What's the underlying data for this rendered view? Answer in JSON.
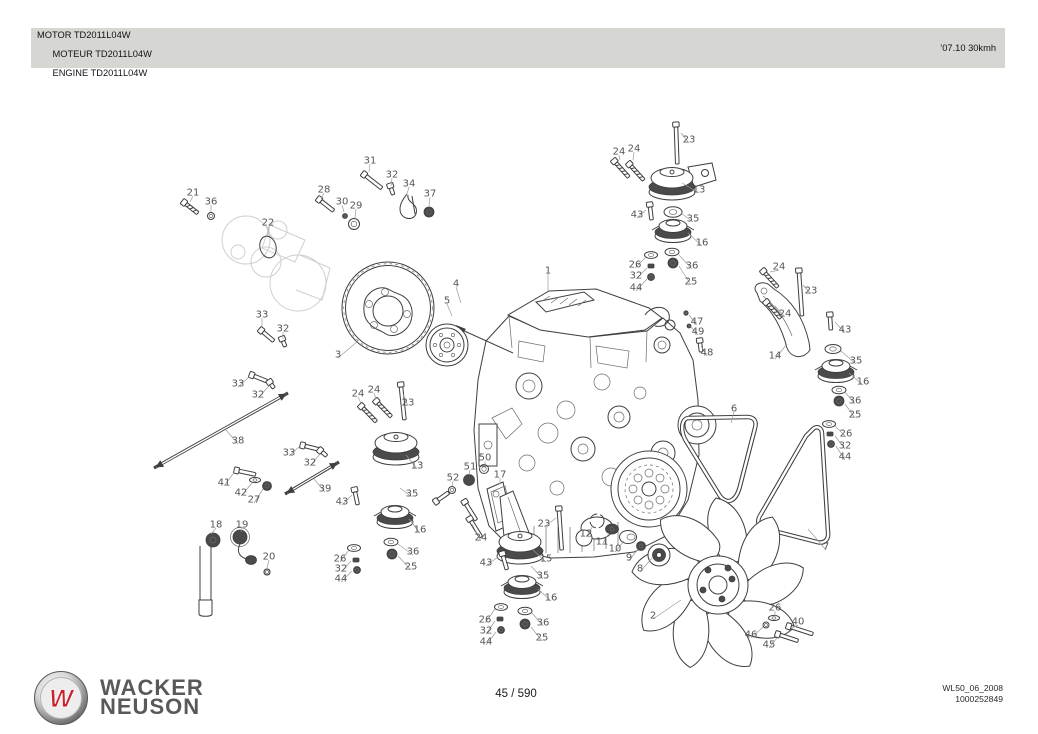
{
  "header": {
    "title_lines": [
      "MOTOR TD2011L04W",
      "MOTEUR TD2011L04W",
      "ENGINE TD2011L04W"
    ],
    "edition": "’07.10 30kmh"
  },
  "footer": {
    "logo_letter": "W",
    "brand_line1": "WACKER",
    "brand_line2": "NEUSON",
    "page_indicator": "45 / 590",
    "doc_code": "WL50_06_2008",
    "doc_number": "1000252849"
  },
  "colors": {
    "header_bar": "#d6d7d3",
    "line_art": "#3f3f3f",
    "callout_text": "#565656",
    "brand_gray": "#59595b",
    "logo_red": "#c8232e"
  },
  "diagram": {
    "description": "Exploded parts view of Deutz engine TD2011L04W with numbered callouts",
    "callouts": [
      {
        "n": "1",
        "x": 548,
        "y": 270,
        "l": [
          548,
          291
        ]
      },
      {
        "n": "2",
        "x": 653,
        "y": 615,
        "l": [
          681,
          600
        ]
      },
      {
        "n": "3",
        "x": 338,
        "y": 354,
        "l": [
          358,
          341
        ]
      },
      {
        "n": "4",
        "x": 456,
        "y": 283,
        "l": [
          461,
          303
        ]
      },
      {
        "n": "5",
        "x": 447,
        "y": 300,
        "l": [
          452,
          316
        ]
      },
      {
        "n": "6",
        "x": 734,
        "y": 408,
        "l": [
          731,
          423
        ]
      },
      {
        "n": "7",
        "x": 826,
        "y": 546,
        "l": [
          808,
          529
        ]
      },
      {
        "n": "8",
        "x": 640,
        "y": 568,
        "l": [
          652,
          558
        ]
      },
      {
        "n": "9",
        "x": 629,
        "y": 557,
        "l": [
          638,
          549
        ]
      },
      {
        "n": "10",
        "x": 615,
        "y": 548,
        "l": [
          624,
          541
        ]
      },
      {
        "n": "11",
        "x": 602,
        "y": 541,
        "l": [
          609,
          533
        ]
      },
      {
        "n": "12",
        "x": 586,
        "y": 533,
        "l": [
          593,
          526
        ]
      },
      {
        "n": "13",
        "x": 699,
        "y": 189,
        "l": [
          682,
          183
        ]
      },
      {
        "n": "13",
        "x": 417,
        "y": 465,
        "l": [
          406,
          455
        ]
      },
      {
        "n": "14",
        "x": 775,
        "y": 355,
        "l": [
          787,
          344
        ]
      },
      {
        "n": "15",
        "x": 546,
        "y": 558,
        "l": [
          532,
          549
        ]
      },
      {
        "n": "16",
        "x": 702,
        "y": 242,
        "l": [
          688,
          233
        ]
      },
      {
        "n": "16",
        "x": 420,
        "y": 529,
        "l": [
          409,
          519
        ]
      },
      {
        "n": "16",
        "x": 863,
        "y": 381,
        "l": [
          849,
          373
        ]
      },
      {
        "n": "16",
        "x": 551,
        "y": 597,
        "l": [
          538,
          589
        ]
      },
      {
        "n": "17",
        "x": 500,
        "y": 474,
        "l": [
          500,
          484
        ]
      },
      {
        "n": "18",
        "x": 216,
        "y": 524,
        "l": [
          211,
          534
        ]
      },
      {
        "n": "19",
        "x": 242,
        "y": 524,
        "l": [
          241,
          532
        ]
      },
      {
        "n": "20",
        "x": 269,
        "y": 556,
        "l": [
          267,
          568
        ]
      },
      {
        "n": "21",
        "x": 193,
        "y": 192,
        "l": [
          190,
          202
        ]
      },
      {
        "n": "22",
        "x": 268,
        "y": 222,
        "l": [
          268,
          236
        ]
      },
      {
        "n": "23",
        "x": 689,
        "y": 139,
        "l": [
          681,
          133
        ]
      },
      {
        "n": "23",
        "x": 811,
        "y": 290,
        "l": [
          803,
          285
        ]
      },
      {
        "n": "23",
        "x": 408,
        "y": 402,
        "l": [
          403,
          394
        ]
      },
      {
        "n": "23",
        "x": 544,
        "y": 523,
        "l": [
          556,
          518
        ]
      },
      {
        "n": "24",
        "x": 619,
        "y": 151,
        "l": [
          620,
          160
        ]
      },
      {
        "n": "24",
        "x": 634,
        "y": 148,
        "l": [
          633,
          160
        ]
      },
      {
        "n": "24",
        "x": 779,
        "y": 266,
        "l": [
          770,
          272
        ]
      },
      {
        "n": "24",
        "x": 785,
        "y": 313,
        "l": [
          775,
          306
        ]
      },
      {
        "n": "24",
        "x": 358,
        "y": 393,
        "l": [
          361,
          403
        ]
      },
      {
        "n": "24",
        "x": 374,
        "y": 389,
        "l": [
          376,
          399
        ]
      },
      {
        "n": "24",
        "x": 481,
        "y": 537,
        "l": [
          472,
          524
        ]
      },
      {
        "n": "25",
        "x": 691,
        "y": 281,
        "l": [
          679,
          266
        ]
      },
      {
        "n": "25",
        "x": 855,
        "y": 414,
        "l": [
          845,
          404
        ]
      },
      {
        "n": "25",
        "x": 411,
        "y": 566,
        "l": [
          398,
          556
        ]
      },
      {
        "n": "25",
        "x": 542,
        "y": 637,
        "l": [
          531,
          627
        ]
      },
      {
        "n": "26",
        "x": 635,
        "y": 264,
        "l": [
          646,
          257
        ]
      },
      {
        "n": "26",
        "x": 846,
        "y": 433,
        "l": [
          835,
          426
        ]
      },
      {
        "n": "26",
        "x": 340,
        "y": 558,
        "l": [
          349,
          550
        ]
      },
      {
        "n": "26",
        "x": 485,
        "y": 619,
        "l": [
          495,
          609
        ]
      },
      {
        "n": "26",
        "x": 775,
        "y": 607,
        "l": [
          775,
          616
        ]
      },
      {
        "n": "27",
        "x": 254,
        "y": 499,
        "l": [
          263,
          489
        ]
      },
      {
        "n": "28",
        "x": 324,
        "y": 189,
        "l": [
          321,
          199
        ]
      },
      {
        "n": "29",
        "x": 356,
        "y": 205,
        "l": [
          355,
          218
        ]
      },
      {
        "n": "30",
        "x": 342,
        "y": 201,
        "l": [
          344,
          212
        ]
      },
      {
        "n": "31",
        "x": 370,
        "y": 160,
        "l": [
          369,
          172
        ]
      },
      {
        "n": "32",
        "x": 392,
        "y": 174,
        "l": [
          391,
          186
        ]
      },
      {
        "n": "32",
        "x": 283,
        "y": 328,
        "l": [
          283,
          339
        ]
      },
      {
        "n": "32",
        "x": 258,
        "y": 394,
        "l": [
          269,
          386
        ]
      },
      {
        "n": "32",
        "x": 310,
        "y": 462,
        "l": [
          320,
          454
        ]
      },
      {
        "n": "32",
        "x": 636,
        "y": 275,
        "l": [
          647,
          268
        ]
      },
      {
        "n": "32",
        "x": 845,
        "y": 445,
        "l": [
          835,
          436
        ]
      },
      {
        "n": "32",
        "x": 341,
        "y": 568,
        "l": [
          351,
          561
        ]
      },
      {
        "n": "32",
        "x": 486,
        "y": 630,
        "l": [
          495,
          621
        ]
      },
      {
        "n": "33",
        "x": 262,
        "y": 314,
        "l": [
          262,
          326
        ]
      },
      {
        "n": "33",
        "x": 238,
        "y": 383,
        "l": [
          249,
          377
        ]
      },
      {
        "n": "33",
        "x": 289,
        "y": 452,
        "l": [
          299,
          447
        ]
      },
      {
        "n": "34",
        "x": 409,
        "y": 183,
        "l": [
          407,
          194
        ]
      },
      {
        "n": "35",
        "x": 693,
        "y": 218,
        "l": [
          681,
          213
        ]
      },
      {
        "n": "35",
        "x": 412,
        "y": 493,
        "l": [
          400,
          488
        ]
      },
      {
        "n": "35",
        "x": 856,
        "y": 360,
        "l": [
          841,
          351
        ]
      },
      {
        "n": "35",
        "x": 543,
        "y": 575,
        "l": [
          531,
          566
        ]
      },
      {
        "n": "36",
        "x": 211,
        "y": 201,
        "l": [
          211,
          212
        ]
      },
      {
        "n": "36",
        "x": 692,
        "y": 265,
        "l": [
          679,
          255
        ]
      },
      {
        "n": "36",
        "x": 855,
        "y": 400,
        "l": [
          845,
          392
        ]
      },
      {
        "n": "36",
        "x": 413,
        "y": 551,
        "l": [
          398,
          544
        ]
      },
      {
        "n": "36",
        "x": 543,
        "y": 622,
        "l": [
          532,
          613
        ]
      },
      {
        "n": "37",
        "x": 430,
        "y": 193,
        "l": [
          429,
          206
        ]
      },
      {
        "n": "38",
        "x": 238,
        "y": 440,
        "l": [
          226,
          430
        ]
      },
      {
        "n": "39",
        "x": 325,
        "y": 488,
        "l": [
          314,
          479
        ]
      },
      {
        "n": "40",
        "x": 798,
        "y": 621,
        "l": [
          792,
          628
        ]
      },
      {
        "n": "41",
        "x": 224,
        "y": 482,
        "l": [
          233,
          474
        ]
      },
      {
        "n": "42",
        "x": 241,
        "y": 492,
        "l": [
          252,
          483
        ]
      },
      {
        "n": "43",
        "x": 637,
        "y": 214,
        "l": [
          646,
          210
        ]
      },
      {
        "n": "43",
        "x": 845,
        "y": 329,
        "l": [
          835,
          322
        ]
      },
      {
        "n": "43",
        "x": 342,
        "y": 501,
        "l": [
          352,
          495
        ]
      },
      {
        "n": "43",
        "x": 486,
        "y": 562,
        "l": [
          498,
          557
        ]
      },
      {
        "n": "44",
        "x": 636,
        "y": 287,
        "l": [
          647,
          279
        ]
      },
      {
        "n": "44",
        "x": 845,
        "y": 456,
        "l": [
          836,
          446
        ]
      },
      {
        "n": "44",
        "x": 341,
        "y": 578,
        "l": [
          352,
          571
        ]
      },
      {
        "n": "44",
        "x": 486,
        "y": 641,
        "l": [
          496,
          632
        ]
      },
      {
        "n": "45",
        "x": 769,
        "y": 644,
        "l": [
          777,
          638
        ]
      },
      {
        "n": "46",
        "x": 751,
        "y": 634,
        "l": [
          763,
          627
        ]
      },
      {
        "n": "47",
        "x": 697,
        "y": 321,
        "l": [
          689,
          315
        ]
      },
      {
        "n": "48",
        "x": 707,
        "y": 352,
        "l": [
          701,
          346
        ]
      },
      {
        "n": "49",
        "x": 698,
        "y": 331,
        "l": [
          691,
          327
        ]
      },
      {
        "n": "50",
        "x": 485,
        "y": 457,
        "l": [
          485,
          466
        ]
      },
      {
        "n": "51",
        "x": 470,
        "y": 466,
        "l": [
          469,
          475
        ]
      },
      {
        "n": "52",
        "x": 453,
        "y": 477,
        "l": [
          452,
          486
        ]
      }
    ]
  }
}
